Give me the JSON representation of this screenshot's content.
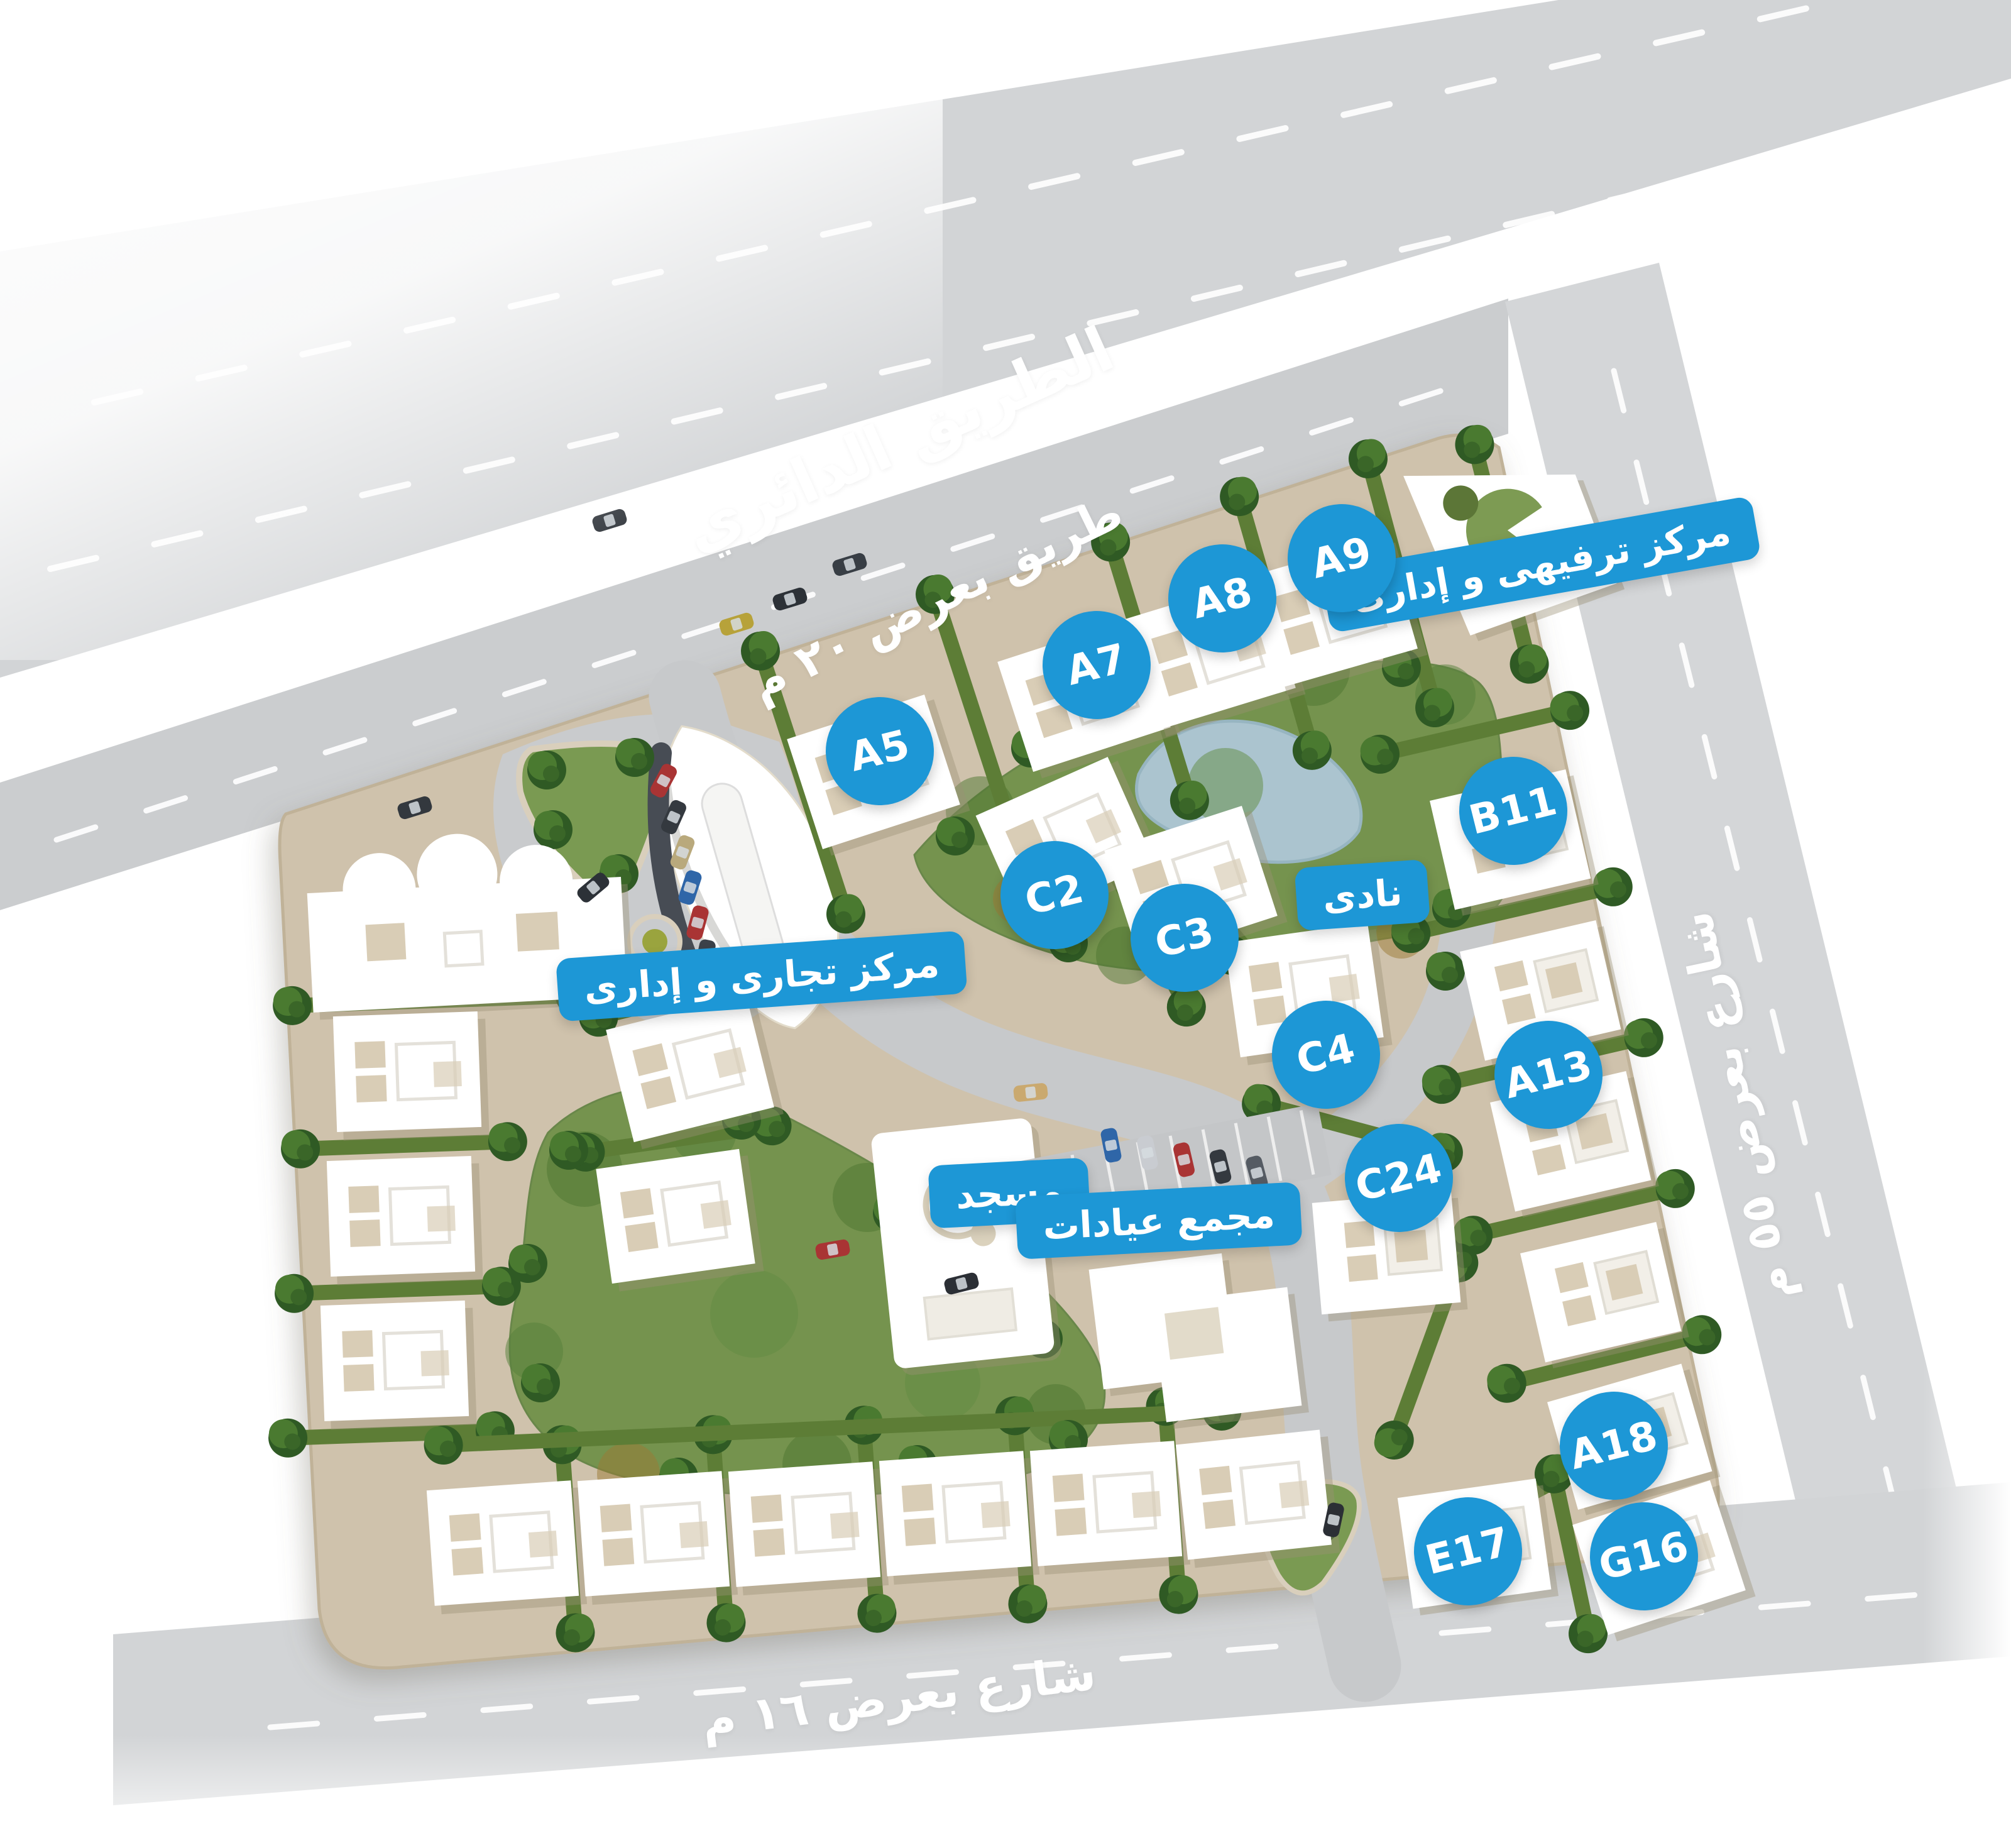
{
  "roads": {
    "ring_road": "الطريق الدائري",
    "road_20m": "طريق بعرض ٢٠ م",
    "street_55m": "شارع بعرض ٥٥ م",
    "street_16m": "شارع بعرض ١٦ م"
  },
  "facilities": {
    "entertainment_admin_center": "مركز ترفيهى و إدارى",
    "commercial_admin_center": "مركز تجارى و إدارى",
    "club": "نادى",
    "mosque": "مسجد",
    "clinics_complex": "مجمع عيادات"
  },
  "units": [
    {
      "label": "A5"
    },
    {
      "label": "A7"
    },
    {
      "label": "A8"
    },
    {
      "label": "A9"
    },
    {
      "label": "B11"
    },
    {
      "label": "C2"
    },
    {
      "label": "C3"
    },
    {
      "label": "C4"
    },
    {
      "label": "C24"
    },
    {
      "label": "A13"
    },
    {
      "label": "A18"
    },
    {
      "label": "E17"
    },
    {
      "label": "G16"
    }
  ],
  "colors": {
    "badge_blue": "#1d97d6",
    "road_gray": "#d2d4d6",
    "inner_road_gray": "#c7c9cb",
    "plot_beige": "#cfc2ac",
    "park_green": "#75934e",
    "hedge_green": "#5d7d36",
    "pond_blue": "#abc4cf",
    "building_white": "#ffffff"
  }
}
